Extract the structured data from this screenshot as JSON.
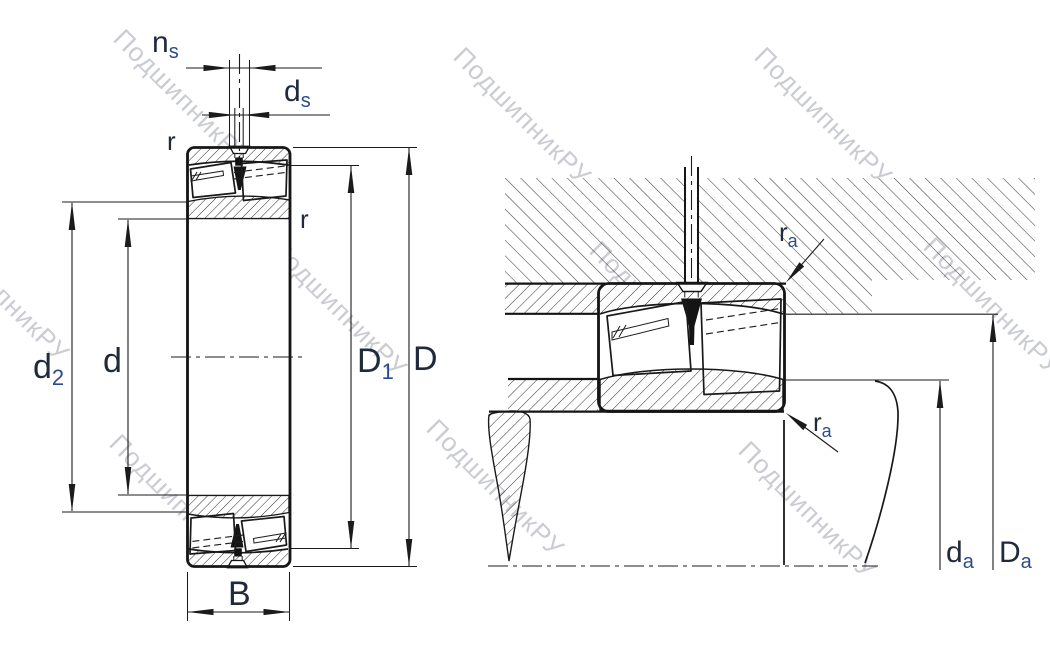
{
  "watermark": {
    "text": "ПодшипникРУ",
    "color": "#bcbec6"
  },
  "colors": {
    "background": "#ffffff",
    "line": "#1b1b1b",
    "label": "#202a3c",
    "label_subscript": "#2b4c8c",
    "watermark": "#bcbec6"
  },
  "figure_left": {
    "name": "bearing-cross-section",
    "labels": {
      "groove_width": {
        "main": "n",
        "sub": "s"
      },
      "hole_diameter": {
        "main": "d",
        "sub": "s"
      },
      "radius_outer": {
        "main": "r"
      },
      "radius_inner": {
        "main": "r"
      },
      "shoulder_diameter": {
        "main": "d",
        "sub": "2"
      },
      "bore_diameter": {
        "main": "d"
      },
      "raceway_diameter": {
        "main": "D",
        "sub": "1"
      },
      "outside_diameter": {
        "main": "D"
      },
      "width": {
        "main": "B"
      }
    }
  },
  "figure_right": {
    "name": "bearing-mounting-drawing",
    "labels": {
      "fillet_top": {
        "main": "r",
        "sub": "a"
      },
      "fillet_bottom": {
        "main": "r",
        "sub": "a"
      },
      "shaft_abutment": {
        "main": "d",
        "sub": "a"
      },
      "housing_abutment": {
        "main": "D",
        "sub": "a"
      }
    }
  }
}
